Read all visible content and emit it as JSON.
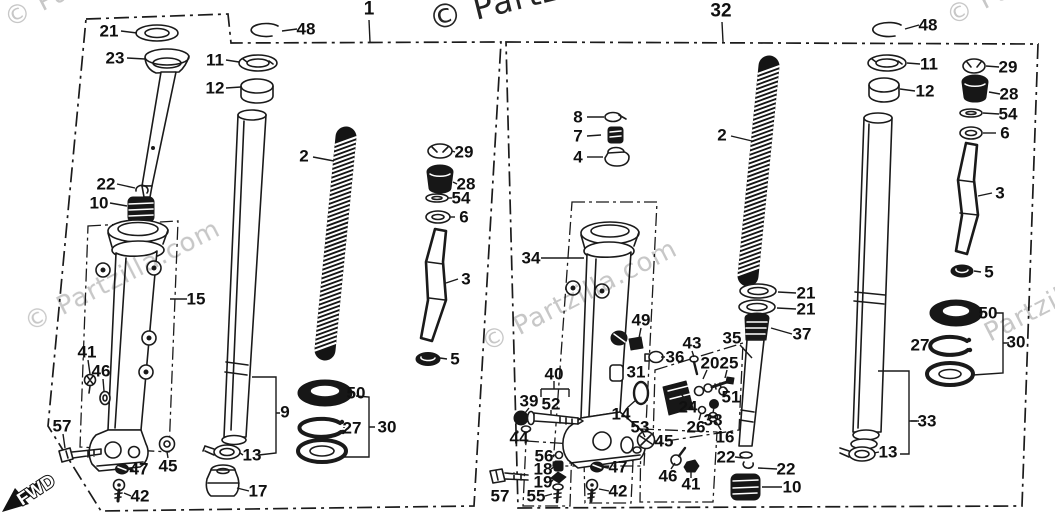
{
  "diagram": {
    "background": "#ffffff",
    "line_color": "#1a1a1a",
    "watermark_color": "#c7c7c7"
  },
  "fwd": {
    "label": "FWD"
  },
  "watermarks": [
    {
      "text": "© Partzilla.com",
      "x": 10,
      "y": 28,
      "rotate": -27,
      "size": 26,
      "color": "#c7c7c7"
    },
    {
      "text": "© Partzilla.com",
      "x": 432,
      "y": 31,
      "rotate": -14,
      "size": 33,
      "color": "#242424"
    },
    {
      "text": "© Partzilla.com",
      "x": 952,
      "y": 26,
      "rotate": -27,
      "size": 26,
      "color": "#c7c7c7"
    },
    {
      "text": "© Partzilla.com",
      "x": 30,
      "y": 332,
      "rotate": -27,
      "size": 26,
      "color": "#c7c7c7"
    },
    {
      "text": "© Partzilla.com",
      "x": 487,
      "y": 352,
      "rotate": -27,
      "size": 26,
      "color": "#c7c7c7"
    },
    {
      "text": "Partzilla.com",
      "x": 990,
      "y": 342,
      "rotate": -27,
      "size": 26,
      "color": "#c7c7c7"
    }
  ],
  "panels": [
    {
      "id": "left",
      "assembly_number": "1",
      "callouts": [
        {
          "n": "1",
          "x": 369,
          "y": 9,
          "big": true,
          "leader": [
            369,
            20,
            370,
            42
          ]
        },
        {
          "n": "48",
          "x": 306,
          "y": 29,
          "leader": [
            297,
            29,
            282,
            31
          ]
        },
        {
          "n": "21",
          "x": 109,
          "y": 31,
          "leader": [
            121,
            31,
            137,
            33
          ]
        },
        {
          "n": "23",
          "x": 115,
          "y": 58,
          "leader": [
            127,
            58,
            145,
            59
          ]
        },
        {
          "n": "11",
          "x": 215,
          "y": 60,
          "leader": [
            226,
            60,
            239,
            62
          ]
        },
        {
          "n": "12",
          "x": 215,
          "y": 88,
          "leader": [
            226,
            88,
            241,
            87
          ]
        },
        {
          "n": "2",
          "x": 304,
          "y": 156,
          "leader": [
            313,
            157,
            334,
            161
          ]
        },
        {
          "n": "29",
          "x": 464,
          "y": 152,
          "leader": [
            455,
            152,
            452,
            151
          ]
        },
        {
          "n": "28",
          "x": 466,
          "y": 184,
          "leader": [
            457,
            184,
            453,
            182
          ]
        },
        {
          "n": "54",
          "x": 461,
          "y": 198,
          "leader": [
            452,
            198,
            448,
            198
          ]
        },
        {
          "n": "6",
          "x": 464,
          "y": 217,
          "leader": [
            455,
            217,
            450,
            217
          ]
        },
        {
          "n": "3",
          "x": 466,
          "y": 279,
          "leader": [
            458,
            279,
            446,
            283
          ]
        },
        {
          "n": "5",
          "x": 455,
          "y": 359,
          "leader": [
            447,
            359,
            440,
            358
          ]
        },
        {
          "n": "22",
          "x": 106,
          "y": 184,
          "leader": [
            117,
            184,
            135,
            188
          ]
        },
        {
          "n": "10",
          "x": 99,
          "y": 203,
          "leader": [
            110,
            203,
            127,
            206
          ]
        },
        {
          "n": "15",
          "x": 196,
          "y": 299,
          "leader": [
            187,
            299,
            170,
            299
          ]
        },
        {
          "n": "41",
          "x": 87,
          "y": 352,
          "leader": [
            88,
            360,
            90,
            374
          ]
        },
        {
          "n": "46",
          "x": 101,
          "y": 371,
          "leader": [
            103,
            379,
            104,
            391
          ]
        },
        {
          "n": "57",
          "x": 62,
          "y": 426,
          "leader": [
            63,
            434,
            65,
            448
          ]
        },
        {
          "n": "45",
          "x": 168,
          "y": 466,
          "leader": [
            168,
            458,
            167,
            452
          ]
        },
        {
          "n": "47",
          "x": 139,
          "y": 469,
          "leader": [
            131,
            469,
            128,
            469
          ]
        },
        {
          "n": "42",
          "x": 140,
          "y": 496,
          "leader": [
            131,
            496,
            124,
            493
          ]
        },
        {
          "n": "9",
          "x": 285,
          "y": 412
        },
        {
          "n": "13",
          "x": 252,
          "y": 455,
          "leader": [
            243,
            455,
            240,
            453
          ]
        },
        {
          "n": "17",
          "x": 258,
          "y": 491,
          "leader": [
            249,
            491,
            237,
            488
          ]
        },
        {
          "n": "50",
          "x": 356,
          "y": 393
        },
        {
          "n": "27",
          "x": 352,
          "y": 428,
          "leader": [
            344,
            428,
            344,
            427
          ]
        },
        {
          "n": "30",
          "x": 387,
          "y": 427
        }
      ]
    },
    {
      "id": "right",
      "assembly_number": "32",
      "callouts": [
        {
          "n": "32",
          "x": 721,
          "y": 11,
          "big": true,
          "leader": [
            722,
            22,
            723,
            42
          ]
        },
        {
          "n": "48",
          "x": 928,
          "y": 25,
          "leader": [
            919,
            25,
            905,
            29
          ]
        },
        {
          "n": "8",
          "x": 578,
          "y": 117,
          "leader": [
            587,
            117,
            604,
            117
          ]
        },
        {
          "n": "7",
          "x": 578,
          "y": 136,
          "leader": [
            587,
            136,
            601,
            135
          ]
        },
        {
          "n": "4",
          "x": 578,
          "y": 157,
          "leader": [
            587,
            157,
            603,
            157
          ]
        },
        {
          "n": "2",
          "x": 722,
          "y": 135,
          "leader": [
            731,
            136,
            752,
            141
          ]
        },
        {
          "n": "11",
          "x": 929,
          "y": 64,
          "leader": [
            920,
            64,
            907,
            63
          ]
        },
        {
          "n": "12",
          "x": 925,
          "y": 91,
          "leader": [
            915,
            91,
            900,
            89
          ]
        },
        {
          "n": "29",
          "x": 1008,
          "y": 67,
          "leader": [
            999,
            67,
            986,
            66
          ]
        },
        {
          "n": "28",
          "x": 1009,
          "y": 94,
          "leader": [
            1000,
            94,
            989,
            92
          ]
        },
        {
          "n": "54",
          "x": 1008,
          "y": 114,
          "leader": [
            999,
            114,
            983,
            113
          ]
        },
        {
          "n": "6",
          "x": 1005,
          "y": 133,
          "leader": [
            996,
            133,
            983,
            133
          ]
        },
        {
          "n": "3",
          "x": 1000,
          "y": 193,
          "leader": [
            992,
            193,
            978,
            196
          ]
        },
        {
          "n": "5",
          "x": 989,
          "y": 272,
          "leader": [
            981,
            272,
            974,
            271
          ]
        },
        {
          "n": "50",
          "x": 988,
          "y": 313
        },
        {
          "n": "27",
          "x": 920,
          "y": 345,
          "leader": [
            929,
            345,
            932,
            345
          ]
        },
        {
          "n": "30",
          "x": 1016,
          "y": 342
        },
        {
          "n": "34",
          "x": 531,
          "y": 258,
          "leader": [
            541,
            258,
            584,
            258
          ]
        },
        {
          "n": "49",
          "x": 641,
          "y": 320,
          "leader": [
            641,
            328,
            639,
            338
          ]
        },
        {
          "n": "36",
          "x": 675,
          "y": 357,
          "leader": [
            665,
            357,
            661,
            357
          ]
        },
        {
          "n": "43",
          "x": 692,
          "y": 343,
          "leader": [
            692,
            351,
            694,
            357
          ]
        },
        {
          "n": "35",
          "x": 732,
          "y": 338,
          "leader": [
            740,
            345,
            752,
            358
          ]
        },
        {
          "n": "20",
          "x": 710,
          "y": 363,
          "leader": [
            707,
            370,
            703,
            379
          ]
        },
        {
          "n": "25",
          "x": 729,
          "y": 363,
          "leader": [
            727,
            370,
            725,
            378
          ]
        },
        {
          "n": "51",
          "x": 731,
          "y": 397,
          "leader": [
            728,
            391,
            724,
            387
          ]
        },
        {
          "n": "24",
          "x": 688,
          "y": 407,
          "leader": [
            686,
            400,
            681,
            394
          ]
        },
        {
          "n": "38",
          "x": 713,
          "y": 420,
          "leader": [
            713,
            413,
            714,
            407
          ]
        },
        {
          "n": "26",
          "x": 696,
          "y": 427,
          "leader": [
            699,
            420,
            701,
            413
          ]
        },
        {
          "n": "16",
          "x": 725,
          "y": 437,
          "leader": [
            721,
            430,
            715,
            420
          ]
        },
        {
          "n": "21",
          "x": 806,
          "y": 293,
          "leader": [
            796,
            293,
            778,
            292
          ]
        },
        {
          "n": "21",
          "x": 806,
          "y": 309,
          "leader": [
            796,
            309,
            777,
            308
          ]
        },
        {
          "n": "37",
          "x": 802,
          "y": 334,
          "leader": [
            792,
            334,
            771,
            328
          ]
        },
        {
          "n": "22",
          "x": 726,
          "y": 457,
          "leader": [
            735,
            457,
            743,
            458
          ]
        },
        {
          "n": "22",
          "x": 786,
          "y": 469,
          "leader": [
            777,
            469,
            758,
            468
          ]
        },
        {
          "n": "10",
          "x": 792,
          "y": 487,
          "leader": [
            782,
            487,
            762,
            487
          ]
        },
        {
          "n": "33",
          "x": 927,
          "y": 421,
          "leader": [
            919,
            421,
            911,
            421
          ]
        },
        {
          "n": "13",
          "x": 888,
          "y": 452,
          "leader": [
            879,
            452,
            874,
            453
          ]
        },
        {
          "n": "31",
          "x": 636,
          "y": 372
        },
        {
          "n": "14",
          "x": 621,
          "y": 414,
          "leader": [
            627,
            408,
            636,
            400
          ]
        },
        {
          "n": "53",
          "x": 640,
          "y": 427,
          "leader": [
            643,
            433,
            645,
            437
          ]
        },
        {
          "n": "45",
          "x": 664,
          "y": 441,
          "leader": [
            656,
            441,
            654,
            441
          ]
        },
        {
          "n": "46",
          "x": 668,
          "y": 476,
          "leader": [
            671,
            469,
            675,
            463
          ]
        },
        {
          "n": "41",
          "x": 691,
          "y": 484,
          "leader": [
            691,
            478,
            691,
            472
          ]
        },
        {
          "n": "40",
          "x": 554,
          "y": 374
        },
        {
          "n": "39",
          "x": 529,
          "y": 401,
          "leader": [
            529,
            408,
            525,
            413
          ]
        },
        {
          "n": "52",
          "x": 551,
          "y": 404,
          "leader": [
            551,
            410,
            551,
            415
          ]
        },
        {
          "n": "44",
          "x": 519,
          "y": 438,
          "leader": [
            525,
            434,
            530,
            430
          ]
        },
        {
          "n": "56",
          "x": 544,
          "y": 456,
          "leader": [
            552,
            456,
            555,
            455
          ]
        },
        {
          "n": "18",
          "x": 543,
          "y": 469,
          "leader": [
            551,
            469,
            554,
            467
          ]
        },
        {
          "n": "19",
          "x": 543,
          "y": 482,
          "leader": [
            551,
            482,
            553,
            480
          ]
        },
        {
          "n": "55",
          "x": 536,
          "y": 496,
          "leader": [
            545,
            496,
            552,
            494
          ]
        },
        {
          "n": "57",
          "x": 500,
          "y": 496
        },
        {
          "n": "47",
          "x": 618,
          "y": 467,
          "leader": [
            609,
            467,
            604,
            467
          ]
        },
        {
          "n": "42",
          "x": 618,
          "y": 491,
          "leader": [
            609,
            491,
            599,
            489
          ]
        }
      ]
    }
  ]
}
